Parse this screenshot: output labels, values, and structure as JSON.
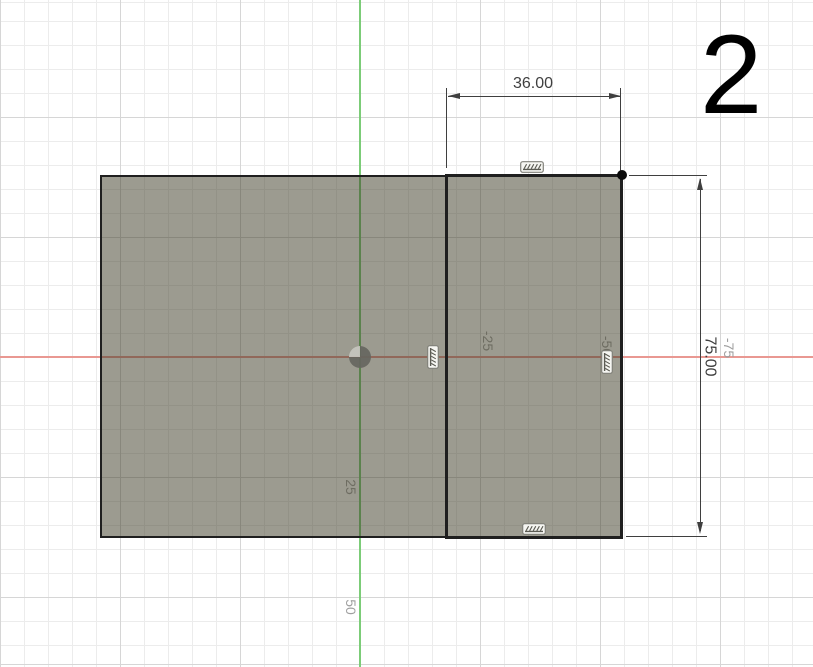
{
  "annotation": {
    "step_number": "2"
  },
  "dimensions": {
    "width": {
      "value": "36.00"
    },
    "height": {
      "value": "75.00"
    }
  },
  "grid_labels": {
    "x_neg_25": "-25",
    "x_neg_50": "-50",
    "x_neg_75": "-75",
    "y_25": "25",
    "y_50": "50"
  },
  "icons": {
    "constraint": "hatched-line-constraint-icon",
    "origin": "origin-point-icon"
  },
  "colors": {
    "axis_x": "#e99892",
    "axis_y": "#7ccc78",
    "profile_fill": "rgba(58,56,34,0.5)",
    "edge": "#1f1f1f",
    "dimension": "#3f3f3f",
    "grid_minor": "#ececec",
    "grid_major": "#d6d6d6",
    "label_inside": "#6e6d62",
    "label_outside": "#9f9f9f",
    "origin_dark": "#66665f",
    "origin_light": "#c6c6bf"
  }
}
